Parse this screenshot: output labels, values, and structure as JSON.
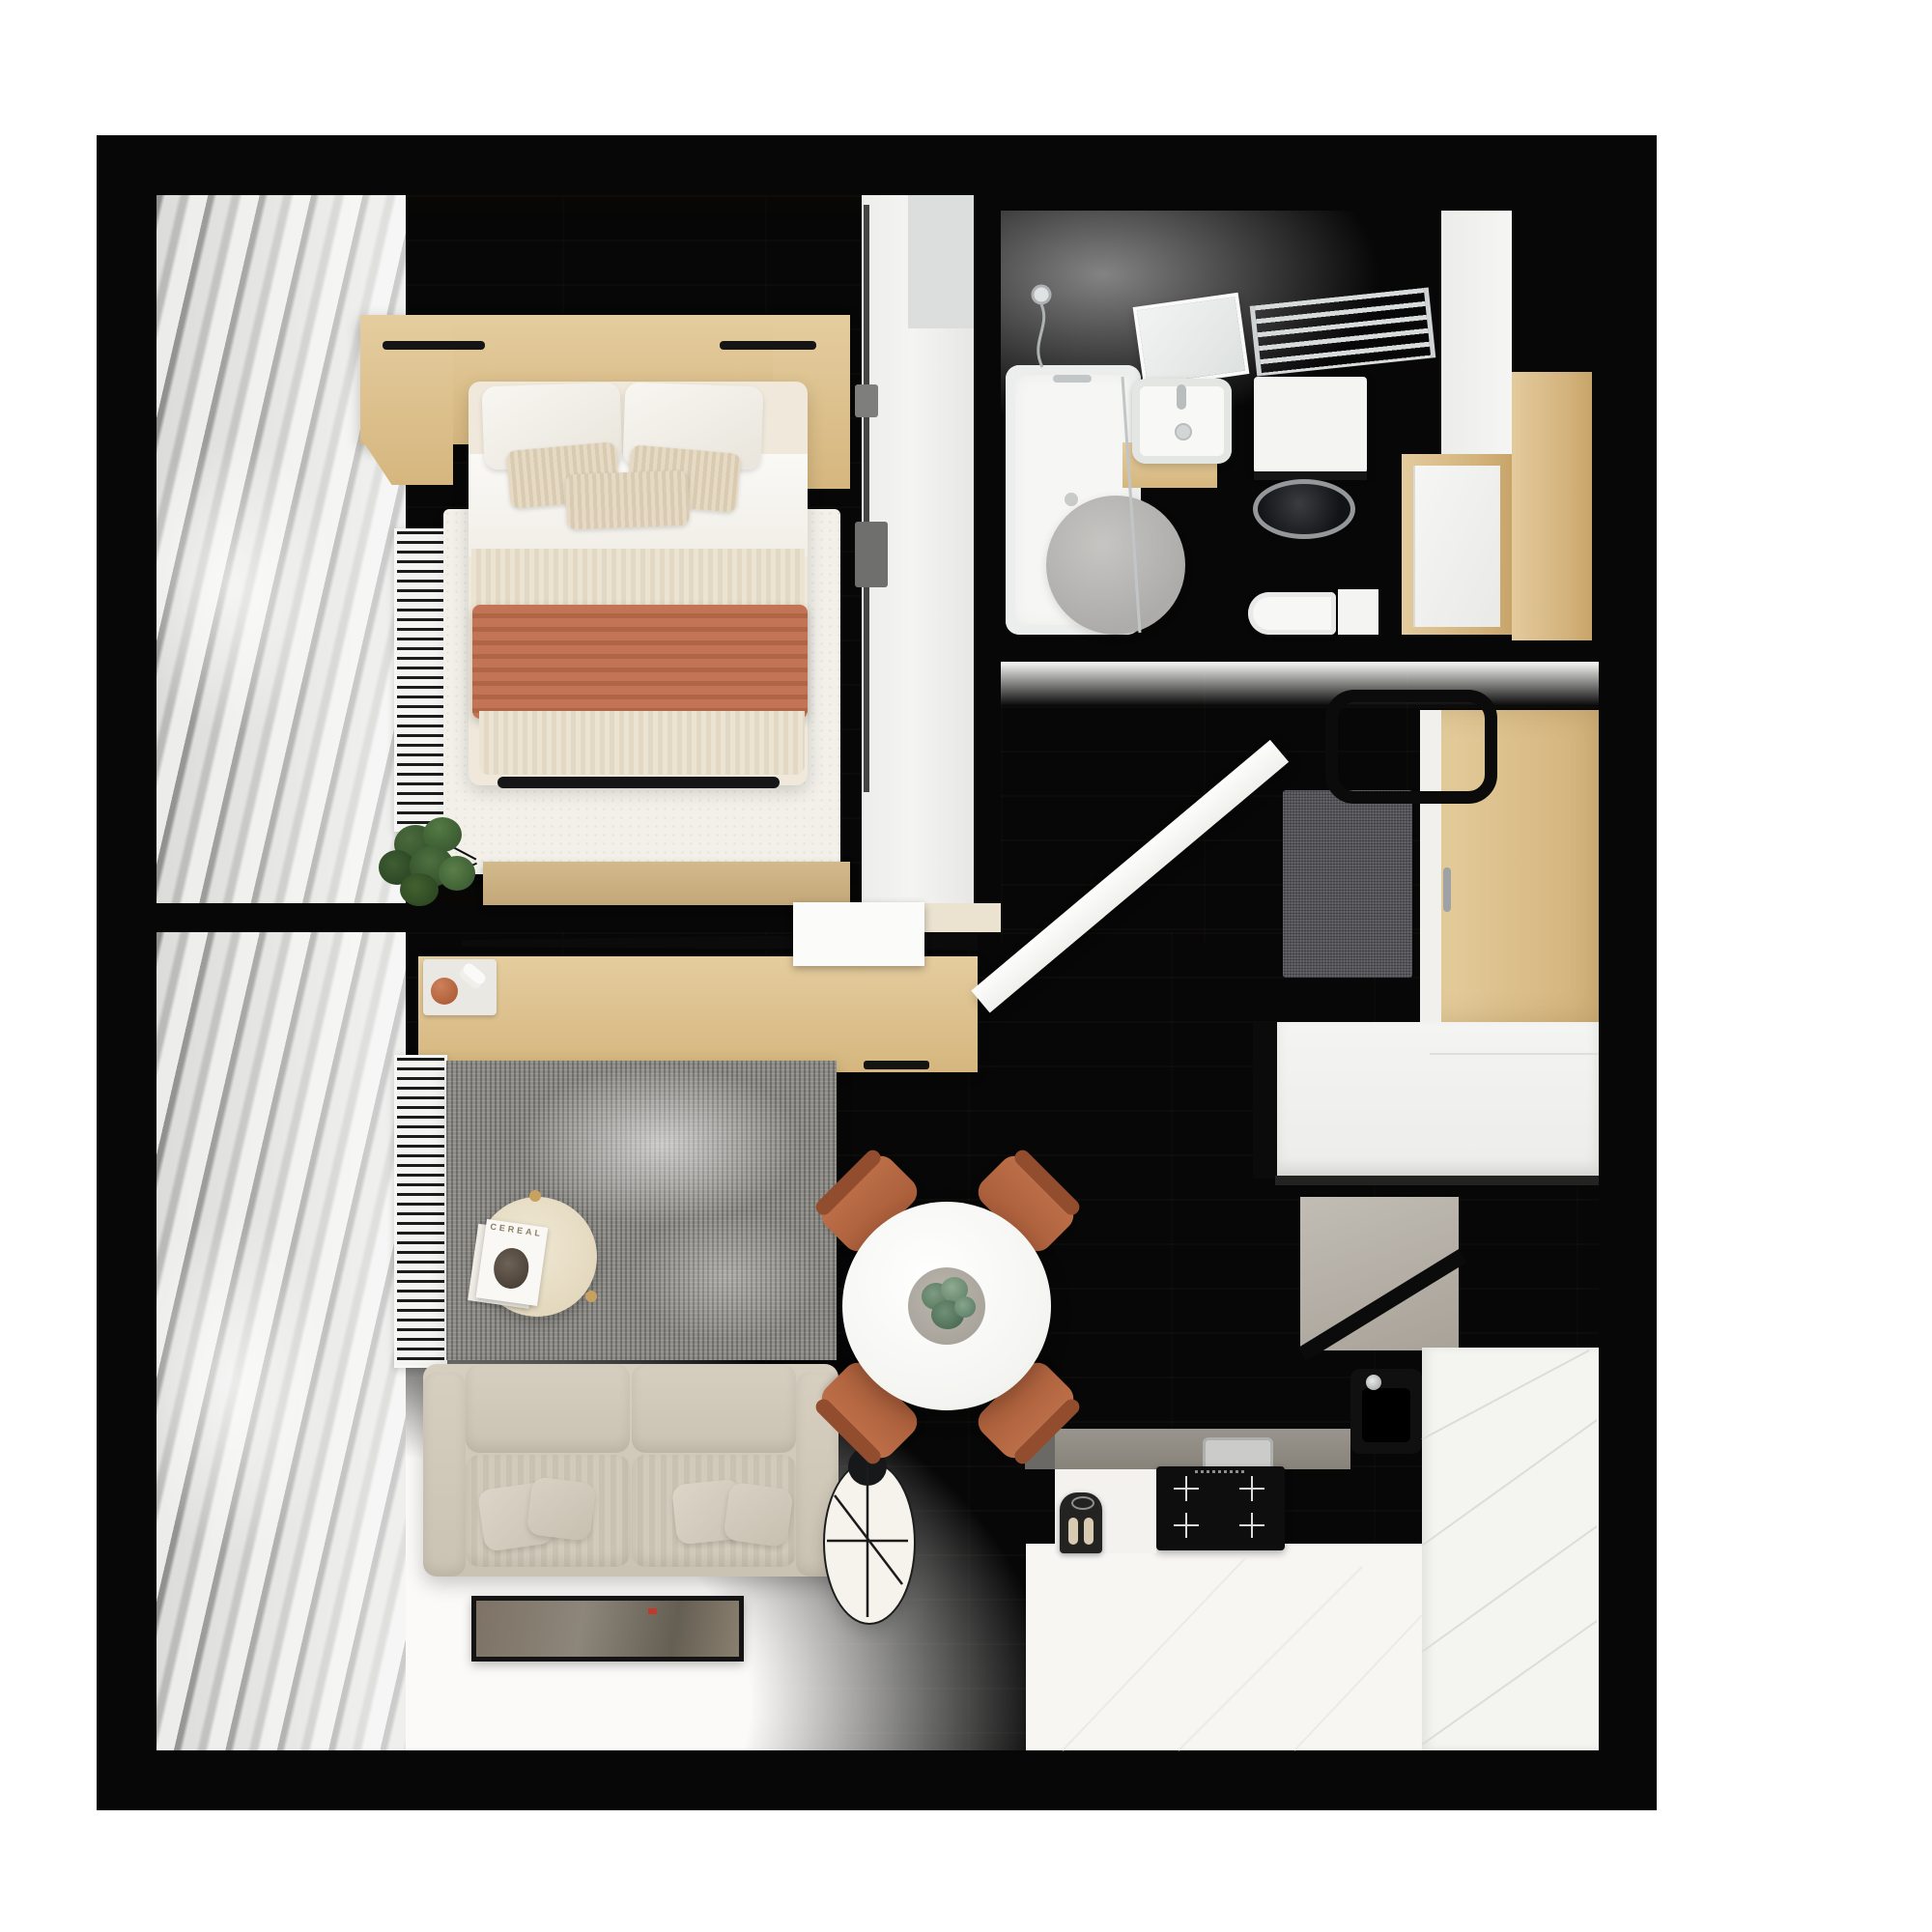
{
  "meta": {
    "type": "apartment-floor-plan",
    "view": "top-down-3d-render",
    "background": "#ffffff"
  },
  "palette": {
    "wall": "#070707",
    "floor-wood": "#e8dec9",
    "tile": "#d2d2d0",
    "oak": "#d8bb88",
    "terracotta": "#bf7050",
    "chair-terracotta": "#b3663f",
    "sofa-beige": "#ccc4b4",
    "rug-gray": "#8d8c87",
    "rug-white": "#f2f0e9",
    "steel": "#8e8a84",
    "chrome": "#c9cccd",
    "greige": "#b7b2a9",
    "doormat": "#56565a",
    "plant-green": "#33502e"
  },
  "rooms": {
    "bedroom": {
      "name": "Bedroom",
      "furniture": [
        "double-bed",
        "wood-headboard-with-nightstands",
        "white-pillows",
        "striped-cushions",
        "terracotta-throw",
        "white-area-rug",
        "window-curtains",
        "radiator",
        "potted-plant",
        "foot-bench",
        "built-in-wardrobe",
        "sliding-tv-panel-rail"
      ]
    },
    "bathroom": {
      "name": "Bathroom",
      "furniture": [
        "bathtub",
        "handheld-shower",
        "glass-screen",
        "mirror",
        "washbasin-on-wood-vanity",
        "towel-radiator",
        "washing-machine",
        "round-stone-rug",
        "toilet",
        "door-niche",
        "tall-white-cabinet"
      ]
    },
    "hallway": {
      "name": "Entry hall",
      "furniture": [
        "open-entry-door",
        "doormat",
        "ceiling-light-frame",
        "wood-wardrobe-console",
        "entry-closet",
        "white-cabinet-block"
      ]
    },
    "kitchen": {
      "name": "Kitchen",
      "furniture": [
        "l-shaped-counter",
        "induction-cooktop",
        "black-sink",
        "coffee-machine",
        "greige-tall-units",
        "white-counter-panels"
      ]
    },
    "living_room": {
      "name": "Living room",
      "furniture": [
        "two-seat-sofa",
        "scatter-pillows",
        "gray-wool-rug",
        "round-coffee-table",
        "magazines",
        "floor-lamp",
        "artwork-on-floor",
        "tv-sideboard",
        "decor-tray",
        "window-curtains",
        "radiator"
      ]
    },
    "dining": {
      "name": "Dining area",
      "furniture": [
        "round-white-table",
        "plant-centerpiece",
        "terracotta-chairs"
      ]
    }
  },
  "living_room": {
    "coffee_table": {
      "magazine_title": "CEREAL"
    }
  }
}
